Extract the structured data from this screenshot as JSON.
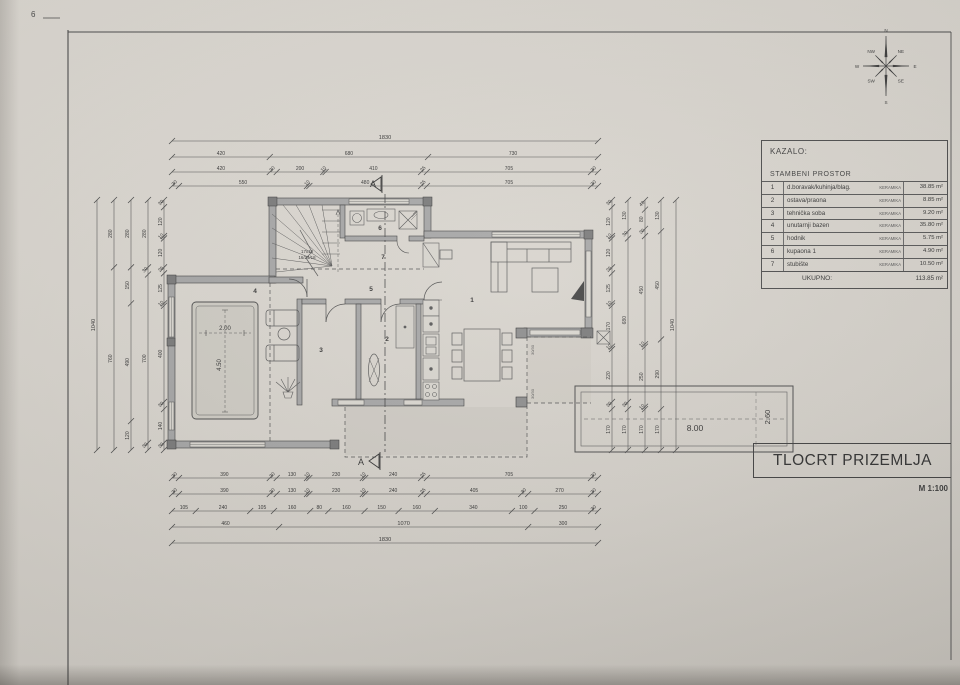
{
  "sheet": {
    "page_mark": "6",
    "title": "TLOCRT PRIZEMLJA",
    "scale": "M 1:100"
  },
  "compass": {
    "labels": [
      "N",
      "NE",
      "E",
      "SE",
      "S",
      "SW",
      "W",
      "NW"
    ]
  },
  "legend": {
    "heading": "KAZALO:",
    "section": "STAMBENI PROSTOR",
    "rows": [
      {
        "no": "1",
        "name": "d.boravak/kuhinja/blag.",
        "material": "KERAMIKA",
        "area": "38.85 m²"
      },
      {
        "no": "2",
        "name": "ostava/praona",
        "material": "KERAMIKA",
        "area": "8.85 m²"
      },
      {
        "no": "3",
        "name": "tehnička soba",
        "material": "KERAMIKA",
        "area": "9.20 m²"
      },
      {
        "no": "4",
        "name": "unutarnji bazen",
        "material": "KERAMIKA",
        "area": "35.80 m²"
      },
      {
        "no": "5",
        "name": "hodnik",
        "material": "KERAMIKA",
        "area": "5.75 m²"
      },
      {
        "no": "6",
        "name": "kupaona 1",
        "material": "KERAMIKA",
        "area": "4.90 m²"
      },
      {
        "no": "7",
        "name": "stubište",
        "material": "KERAMIKA",
        "area": "10.50 m²"
      }
    ],
    "total_label": "UKUPNO:",
    "total_area": "113.85 m²"
  },
  "plan": {
    "room_numbers": [
      "1",
      "2",
      "3",
      "4",
      "5",
      "6",
      "7"
    ],
    "section_marker": "A",
    "stair_note": [
      "17x18",
      "16/24/18"
    ],
    "indoor_pool": {
      "width": "2.00",
      "length": "4.50"
    },
    "outdoor_pool": {
      "length": "8.00",
      "width": "2.60"
    },
    "post_label": "30/30"
  },
  "dimensions": {
    "top": [
      [
        1830
      ],
      [
        420,
        680,
        730
      ],
      [
        420,
        30,
        200,
        10,
        410,
        25,
        705,
        30
      ],
      [
        30,
        550,
        10,
        480,
        25,
        705,
        30
      ]
    ],
    "bottom": [
      [
        30,
        390,
        30,
        130,
        10,
        230,
        10,
        240,
        25,
        705,
        30
      ],
      [
        30,
        390,
        30,
        130,
        10,
        230,
        10,
        240,
        25,
        405,
        30,
        270,
        30
      ],
      [
        105,
        240,
        105,
        160,
        80,
        160,
        150,
        160,
        340,
        100,
        250,
        30
      ],
      [
        460,
        1070,
        300
      ],
      [
        1830
      ]
    ],
    "left": [
      [
        1040
      ],
      [
        280,
        760
      ],
      [
        280,
        150,
        490,
        120
      ],
      [
        280,
        30,
        700,
        30
      ],
      [
        30,
        120,
        10,
        120,
        25,
        125,
        10,
        400,
        30,
        140,
        30
      ]
    ],
    "right": [
      [
        30,
        120,
        10,
        120,
        25,
        125,
        10,
        170,
        10,
        220,
        30,
        170
      ],
      [
        130,
        30,
        680,
        30,
        170
      ],
      [
        40,
        80,
        30,
        450,
        10,
        250,
        10,
        170
      ],
      [
        130,
        450,
        290,
        170
      ],
      [
        1040
      ]
    ]
  }
}
